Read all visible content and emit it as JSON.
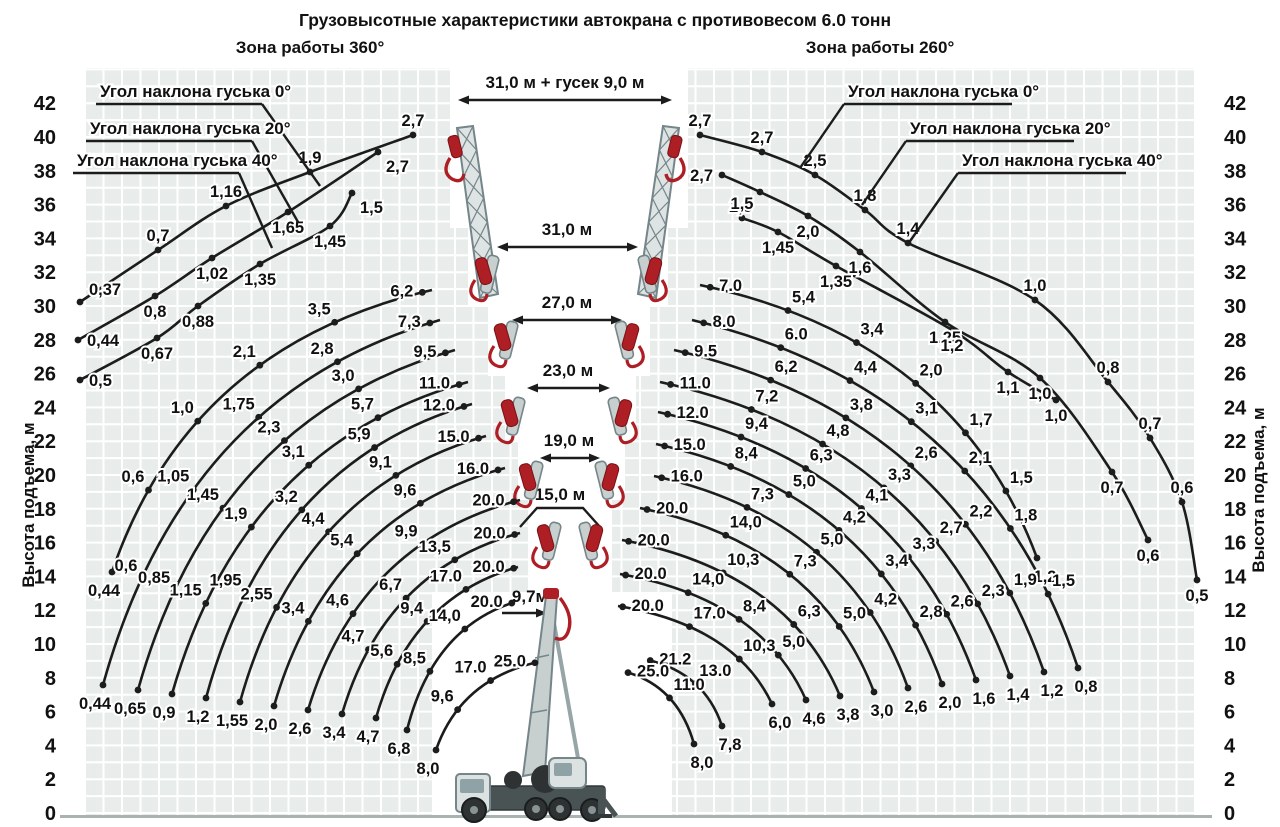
{
  "title": "Грузовысотные характеристики автокрана с противовесом 6.0 тонн",
  "left_zone_label": "Зона работы 360°",
  "right_zone_label": "Зона работы 260°",
  "y_axis": {
    "label": "Высота подъема, м",
    "ticks": [
      42,
      40,
      38,
      36,
      34,
      32,
      30,
      28,
      26,
      24,
      22,
      20,
      18,
      16,
      14,
      12,
      10,
      8,
      6,
      4,
      2,
      0
    ]
  },
  "annotations": {
    "dimensions": [
      {
        "label": "31,0 м + гусек 9,0 м",
        "x1": 458,
        "x2": 672,
        "y": 100,
        "lx": 565,
        "ly": 88
      },
      {
        "label": "31,0 м",
        "x1": 497,
        "x2": 638,
        "y": 247,
        "lx": 567,
        "ly": 235
      },
      {
        "label": "27,0 м",
        "x1": 512,
        "x2": 622,
        "y": 320,
        "lx": 567,
        "ly": 308
      },
      {
        "label": "23,0 м",
        "x1": 527,
        "x2": 610,
        "y": 388,
        "lx": 568,
        "ly": 376
      },
      {
        "label": "19,0 м",
        "x1": 540,
        "x2": 600,
        "y": 458,
        "lx": 569,
        "ly": 446
      }
    ],
    "bracket15": {
      "label": "15,0 м",
      "lx": 560,
      "ly": 500,
      "pts": [
        [
          520,
          527
        ],
        [
          537,
          508
        ],
        [
          583,
          508
        ],
        [
          600,
          527
        ]
      ]
    },
    "boom_min": {
      "label": "9,7м",
      "lx": 530,
      "ly": 602,
      "ax1": 502,
      "ax2": 547,
      "ay": 613
    },
    "jib_callouts_left": [
      {
        "text": "Угол наклона гуська 0°",
        "tx": 100,
        "ty": 97,
        "u": [
          96,
          104,
          262,
          104
        ],
        "l": [
          262,
          104,
          320,
          186
        ]
      },
      {
        "text": "Угол наклона гуська 20°",
        "tx": 90,
        "ty": 134,
        "u": [
          86,
          141,
          252,
          141
        ],
        "l": [
          252,
          141,
          298,
          222
        ]
      },
      {
        "text": "Угол наклона гуська 40°",
        "tx": 77,
        "ty": 166,
        "u": [
          73,
          173,
          239,
          173
        ],
        "l": [
          239,
          173,
          272,
          248
        ]
      }
    ],
    "jib_callouts_right": [
      {
        "text": "Угол наклона гуська 0°",
        "tx": 848,
        "ty": 97,
        "u": [
          844,
          104,
          1012,
          104
        ],
        "l": [
          844,
          104,
          800,
          168
        ]
      },
      {
        "text": "Угол наклона гуська 20°",
        "tx": 910,
        "ty": 134,
        "u": [
          906,
          141,
          1074,
          141
        ],
        "l": [
          906,
          141,
          862,
          205
        ]
      },
      {
        "text": "Угол наклона гуська 40°",
        "tx": 962,
        "ty": 166,
        "u": [
          958,
          173,
          1126,
          173
        ],
        "l": [
          958,
          173,
          908,
          244
        ]
      }
    ]
  },
  "chart_data": {
    "type": "line",
    "description": "Load (tonnes) vs lifting height curves for each boom length; values in tonnes along each curve",
    "left_fan": [
      {
        "top": [
          432,
          290
        ],
        "end": [
          112,
          572
        ],
        "values": [
          "6,2",
          "3,5",
          "2,1",
          "1,0",
          "0,6",
          "0,44"
        ]
      },
      {
        "top": [
          440,
          320
        ],
        "end": [
          103,
          685
        ],
        "values": [
          "7,3",
          "2,8",
          "1,75",
          "1,05",
          "0,6",
          "0,44"
        ]
      },
      {
        "top": [
          455,
          350
        ],
        "end": [
          138,
          690
        ],
        "values": [
          "9,5",
          "3,0",
          "2,3",
          "1,45",
          "0,85",
          "0,65"
        ]
      },
      {
        "top": [
          468,
          382
        ],
        "end": [
          172,
          694
        ],
        "values": [
          "11.0",
          "5,7",
          "3,1",
          "1,9",
          "1,15",
          "0,9"
        ]
      },
      {
        "top": [
          472,
          404
        ],
        "end": [
          206,
          698
        ],
        "values": [
          "12.0",
          "5,9",
          "3,2",
          "1,95",
          "1,2"
        ]
      },
      {
        "top": [
          486,
          436
        ],
        "end": [
          240,
          702
        ],
        "values": [
          "15.0",
          "9,1",
          "4,4",
          "2,55",
          "1,55"
        ]
      },
      {
        "top": [
          505,
          468
        ],
        "end": [
          274,
          706
        ],
        "values": [
          "16.0",
          "9,6",
          "5,4",
          "3,4",
          "2,0"
        ]
      },
      {
        "top": [
          520,
          500
        ],
        "end": [
          308,
          710
        ],
        "values": [
          "20.0",
          "9,9",
          "4,6",
          "2,6"
        ]
      },
      {
        "top": [
          520,
          533
        ],
        "end": [
          342,
          714
        ],
        "values": [
          "20.0",
          "13,5",
          "6,7",
          "4,7",
          "3,4"
        ]
      },
      {
        "top": [
          518,
          567
        ],
        "end": [
          376,
          718
        ],
        "values": [
          "20.0",
          "17.0",
          "9,4",
          "5,6",
          "4,7"
        ]
      },
      {
        "top": [
          515,
          602
        ],
        "end": [
          407,
          730
        ],
        "values": [
          "20.0",
          "14,0",
          "8,5",
          "6,8"
        ]
      },
      {
        "top": [
          538,
          662
        ],
        "end": [
          436,
          750
        ],
        "values": [
          "25.0",
          "17.0",
          "9,6",
          "8,0"
        ]
      }
    ],
    "right_fan": [
      {
        "top": [
          700,
          285
        ],
        "end": [
          1037,
          558
        ],
        "values": [
          "7.0",
          "5,4",
          "3,4",
          "2,0",
          "1,7",
          "1,5",
          "1,2"
        ]
      },
      {
        "top": [
          692,
          320
        ],
        "end": [
          1078,
          668
        ],
        "values": [
          "8.0",
          "6.0",
          "4,4",
          "3,1",
          "2,1",
          "1,8",
          "1,5",
          "0,8"
        ]
      },
      {
        "top": [
          674,
          350
        ],
        "end": [
          1044,
          672
        ],
        "values": [
          "9.5",
          "6,2",
          "3,8",
          "2,6",
          "2,2",
          "1,9",
          "1,2"
        ]
      },
      {
        "top": [
          660,
          382
        ],
        "end": [
          1010,
          676
        ],
        "values": [
          "11.0",
          "7,2",
          "4,8",
          "3,3",
          "2,7",
          "2,3",
          "1,4"
        ]
      },
      {
        "top": [
          658,
          412
        ],
        "end": [
          976,
          680
        ],
        "values": [
          "12.0",
          "9,4",
          "6,3",
          "4,1",
          "3,3",
          "2,6",
          "1,6"
        ]
      },
      {
        "top": [
          656,
          444
        ],
        "end": [
          942,
          684
        ],
        "values": [
          "15.0",
          "8,4",
          "5,0",
          "4,2",
          "3,4",
          "2,8",
          "2,0"
        ]
      },
      {
        "top": [
          654,
          476
        ],
        "end": [
          908,
          688
        ],
        "values": [
          "16.0",
          "7,3",
          "5,0",
          "4,2",
          "2,6"
        ]
      },
      {
        "top": [
          640,
          508
        ],
        "end": [
          874,
          692
        ],
        "values": [
          "20.0",
          "14,0",
          "7,3",
          "5,0",
          "3,0"
        ]
      },
      {
        "top": [
          622,
          540
        ],
        "end": [
          840,
          696
        ],
        "values": [
          "20.0",
          "10,3",
          "6,3",
          "3,8"
        ]
      },
      {
        "top": [
          620,
          574
        ],
        "end": [
          806,
          700
        ],
        "values": [
          "20.0",
          "14,0",
          "8,4",
          "5,0",
          "4,6"
        ]
      },
      {
        "top": [
          618,
          606
        ],
        "end": [
          772,
          704
        ],
        "values": [
          "20.0",
          "17.0",
          "10,3",
          "6,0"
        ]
      },
      {
        "top": [
          648,
          660
        ],
        "end": [
          722,
          726
        ],
        "values": [
          "21.2",
          "13.0",
          "7,8"
        ]
      },
      {
        "top": [
          626,
          672
        ],
        "end": [
          694,
          744
        ],
        "values": [
          "25.0",
          "11.0",
          "8,0"
        ]
      }
    ],
    "left_jib_curves": [
      {
        "angle": "0°",
        "points": [
          [
            80,
            302,
            "0,37",
            "ar"
          ],
          [
            158,
            250,
            "0,7",
            "a"
          ],
          [
            226,
            206,
            "1,16",
            "a"
          ],
          [
            310,
            172,
            "1,9",
            "a"
          ],
          [
            413,
            135,
            "2,7",
            "a"
          ]
        ]
      },
      {
        "angle": "20°",
        "points": [
          [
            78,
            340,
            "0,44",
            "r"
          ],
          [
            155,
            296,
            "0,8",
            "b"
          ],
          [
            212,
            258,
            "1,02",
            "b"
          ],
          [
            288,
            212,
            "1,65",
            "b"
          ],
          [
            378,
            152,
            "2,7",
            "br"
          ]
        ]
      },
      {
        "angle": "40°",
        "points": [
          [
            80,
            380,
            "0,5",
            "r"
          ],
          [
            157,
            338,
            "0,67",
            "b"
          ],
          [
            198,
            306,
            "0,88",
            "b"
          ],
          [
            260,
            264,
            "1,35",
            "b"
          ],
          [
            330,
            226,
            "1,45",
            "b"
          ],
          [
            352,
            193,
            "1,5",
            "br"
          ]
        ]
      }
    ],
    "right_jib_curves": [
      {
        "angle": "0°",
        "points": [
          [
            700,
            135,
            "2,7",
            "a"
          ],
          [
            762,
            152,
            "2,7",
            "a"
          ],
          [
            815,
            175,
            "2,5",
            "a"
          ],
          [
            865,
            210,
            "1,8",
            "a"
          ],
          [
            908,
            243,
            "1,4",
            "a"
          ],
          [
            1035,
            300,
            "1,0",
            "a"
          ],
          [
            1108,
            382,
            "0,8",
            "a"
          ],
          [
            1150,
            438,
            "0,7",
            "a"
          ],
          [
            1182,
            502,
            "0,6",
            "a"
          ],
          [
            1197,
            580,
            "0,5",
            "b"
          ]
        ]
      },
      {
        "angle": "20°",
        "points": [
          [
            722,
            175,
            "2,7",
            "l"
          ],
          [
            760,
            192,
            "2,6",
            "bl"
          ],
          [
            808,
            216,
            "2,0",
            "b"
          ],
          [
            860,
            252,
            "1,6",
            "b"
          ],
          [
            945,
            322,
            "1,25",
            "b"
          ],
          [
            1040,
            378,
            "1,0",
            "b"
          ],
          [
            1112,
            472,
            "0,7",
            "b"
          ],
          [
            1148,
            540,
            "0,6",
            "b"
          ]
        ]
      },
      {
        "angle": "40°",
        "points": [
          [
            742,
            218,
            "1,5",
            "a"
          ],
          [
            778,
            232,
            "1,45",
            "b"
          ],
          [
            836,
            266,
            "1,35",
            "b"
          ],
          [
            952,
            330,
            "1,2",
            "b"
          ],
          [
            1008,
            372,
            "1,1",
            "b"
          ],
          [
            1056,
            400,
            "1,0",
            "b"
          ]
        ]
      }
    ]
  },
  "colors": {
    "curve": "#1c1c1c",
    "grid_bg": "#e8edec",
    "grid_line": "#ffffff",
    "machine_red": "#ad1f24",
    "machine_red_dark": "#7a1114",
    "machine_gray": "#c7d0cf",
    "machine_outline": "#75858a",
    "dark": "#2e3233",
    "text": "#111111"
  }
}
